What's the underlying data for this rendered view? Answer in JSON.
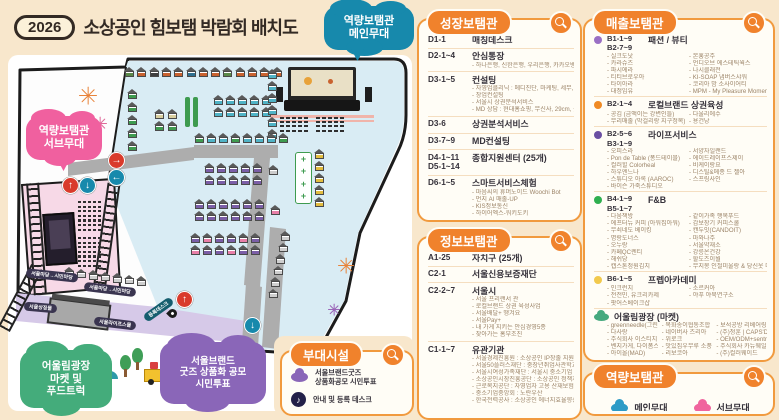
{
  "header": {
    "year_badge": "2026",
    "title": "소상공인 힘보탬 박람회 배치도"
  },
  "colors": {
    "accent_orange": "#F0822C",
    "page_bg": "#F8E7CC",
    "venue_blue": "#D9ECF4",
    "stage_pink": "#F7D9E7",
    "walkway_purple": "#D6C9E8",
    "bubble_blue": "#1789AC",
    "bubble_pink": "#F0609F",
    "bubble_green": "#44AC7B",
    "bubble_purple": "#8A66B8"
  },
  "map": {
    "bubbles": [
      {
        "id": "main-stage-bubble",
        "text": "역량보탬관\n메인무대",
        "color": "#1789AC",
        "x": 324,
        "y": 6,
        "w": 90,
        "h": 44,
        "fs": 11,
        "tail_left": 26
      },
      {
        "id": "sub-stage-bubble",
        "text": "역량보탬관\n서브무대",
        "color": "#F0609F",
        "x": 26,
        "y": 116,
        "w": 76,
        "h": 44,
        "fs": 11,
        "tail_left": 30
      },
      {
        "id": "plaza-bubble",
        "text": "어울림광장\n마켓 및\n푸드트럭",
        "color": "#44AC7B",
        "x": 20,
        "y": 350,
        "w": 92,
        "h": 58,
        "fs": 10.5
      },
      {
        "id": "goods-vote-bubble",
        "text": "서울브랜드\n굿즈 상품화 공모\n시민투표",
        "color": "#8A66B8",
        "x": 160,
        "y": 342,
        "w": 106,
        "h": 62,
        "fs": 9.5
      }
    ],
    "arrows": [
      {
        "sym": "↑",
        "color": "#d93a2b",
        "x": 54,
        "y": 122
      },
      {
        "sym": "↓",
        "color": "#1789ac",
        "x": 71,
        "y": 122
      },
      {
        "sym": "→",
        "color": "#d93a2b",
        "x": 100,
        "y": 97
      },
      {
        "sym": "←",
        "color": "#1789ac",
        "x": 100,
        "y": 114
      },
      {
        "sym": "↑",
        "color": "#d93a2b",
        "x": 168,
        "y": 236
      },
      {
        "sym": "↓",
        "color": "#1789ac",
        "x": 236,
        "y": 262
      }
    ],
    "road_labels": [
      {
        "text": "서울마당→시민마당",
        "x": 18,
        "y": 216,
        "rot": 6,
        "bg": "#3a3550"
      },
      {
        "text": "서울마당→시민마당",
        "x": 76,
        "y": 230,
        "rot": 7,
        "bg": "#3a3550"
      },
      {
        "text": "서울상징물",
        "x": 16,
        "y": 248,
        "rot": 5,
        "bg": "#3a3550"
      },
      {
        "text": "서울라이프스몰",
        "x": 86,
        "y": 264,
        "rot": 7,
        "bg": "#3a3550"
      },
      {
        "text": "등록데스크",
        "x": 134,
        "y": 250,
        "rot": -35,
        "bg": "#155e6e"
      }
    ],
    "fireworks": [
      {
        "x": 80,
        "y": 40,
        "color": "#e8833a",
        "r": 9
      },
      {
        "x": 92,
        "y": 68,
        "color": "#e06a9a",
        "r": 7
      },
      {
        "x": 338,
        "y": 210,
        "color": "#e8833a",
        "r": 8
      },
      {
        "x": 326,
        "y": 254,
        "color": "#9a66b8",
        "r": 6
      }
    ],
    "booth_groups": [
      {
        "x": 116,
        "y": 12,
        "dx": 12.3,
        "dy": 0,
        "colors": [
          "#5a8a4a",
          "#c9622f",
          "#3f3f3f",
          "#c9622f",
          "#c9622f",
          "#2f6f8f",
          "#c9622f",
          "#c9622f",
          "#5a8a4a",
          "#c9622f",
          "#c9622f",
          "#c9622f",
          "#c9622f"
        ]
      },
      {
        "x": 119,
        "y": 34,
        "dx": 0,
        "dy": 13,
        "colors": [
          "#3e9b4f",
          "#3e9b4f",
          "#3e9b4f",
          "#3e9b4f",
          "#3e9b4f"
        ]
      },
      {
        "x": 146,
        "y": 54,
        "dx": 13,
        "dy": 0,
        "colors": [
          "#d9cf9f",
          "#d9cf9f"
        ]
      },
      {
        "x": 146,
        "y": 66,
        "dx": 13,
        "dy": 0,
        "colors": [
          "#3e9b4f",
          "#3e9b4f"
        ]
      },
      {
        "x": 205,
        "y": 40,
        "dx": 12,
        "dy": 0,
        "colors": [
          "#4fb3c6",
          "#4fb3c6",
          "#4fb3c6",
          "#4fb3c6",
          "#4fb3c6"
        ]
      },
      {
        "x": 205,
        "y": 52,
        "dx": 12,
        "dy": 0,
        "colors": [
          "#4fb3c6",
          "#4fb3c6",
          "#4fb3c6",
          "#4fb3c6",
          "#4fb3c6"
        ]
      },
      {
        "x": 259,
        "y": 14,
        "dx": 0,
        "dy": 12,
        "colors": [
          "#4fb3c6",
          "#4fb3c6",
          "#4fb3c6",
          "#4fb3c6",
          "#4fb3c6",
          "#4fb3c6"
        ]
      },
      {
        "x": 186,
        "y": 78,
        "dx": 12,
        "dy": 0,
        "colors": [
          "#3e9b4f",
          "#4fb3c6",
          "#4fb3c6",
          "#3e9b4f",
          "#4fb3c6",
          "#4fb3c6",
          "#4fb3c6",
          "#3e9b4f"
        ]
      },
      {
        "x": 196,
        "y": 108,
        "dx": 12,
        "dy": 0,
        "colors": [
          "#7b5ea7",
          "#7b5ea7",
          "#7b5ea7",
          "#7b5ea7",
          "#7b5ea7"
        ]
      },
      {
        "x": 196,
        "y": 120,
        "dx": 12,
        "dy": 0,
        "colors": [
          "#7b5ea7",
          "#7b5ea7",
          "#7b5ea7",
          "#7b5ea7",
          "#7b5ea7"
        ]
      },
      {
        "x": 260,
        "y": 110,
        "dx": 0,
        "dy": 0,
        "colors": [
          "#cccccc"
        ]
      },
      {
        "x": 186,
        "y": 144,
        "dx": 12,
        "dy": 0,
        "colors": [
          "#7b5ea7",
          "#7b5ea7",
          "#7b5ea7",
          "#7b5ea7",
          "#7b5ea7",
          "#7b5ea7"
        ]
      },
      {
        "x": 186,
        "y": 156,
        "dx": 12,
        "dy": 0,
        "colors": [
          "#7b5ea7",
          "#7b5ea7",
          "#7b5ea7",
          "#7b5ea7",
          "#7b5ea7",
          "#7b5ea7"
        ]
      },
      {
        "x": 262,
        "y": 150,
        "dx": 0,
        "dy": 0,
        "colors": [
          "#e87fa8"
        ]
      },
      {
        "x": 306,
        "y": 94,
        "dx": 0,
        "dy": 12,
        "colors": [
          "#e3bd3f",
          "#e3bd3f",
          "#e3bd3f",
          "#e3bd3f",
          "#e3bd3f"
        ]
      },
      {
        "x": 182,
        "y": 178,
        "dx": 12,
        "dy": 0,
        "colors": [
          "#7b5ea7",
          "#e87fa8",
          "#7b5ea7",
          "#7b5ea7",
          "#e87fa8",
          "#7b5ea7"
        ]
      },
      {
        "x": 182,
        "y": 190,
        "dx": 12,
        "dy": 0,
        "colors": [
          "#e87fa8",
          "#7b5ea7",
          "#7b5ea7",
          "#e87fa8",
          "#7b5ea7",
          "#7b5ea7"
        ]
      },
      {
        "x": 56,
        "y": 212,
        "dx": 12,
        "dy": 1.5,
        "colors": [
          "#cfcfcf",
          "#cfcfcf",
          "#cfcfcf",
          "#cfcfcf",
          "#cfcfcf",
          "#cfcfcf",
          "#cfcfcf"
        ]
      },
      {
        "x": 272,
        "y": 176,
        "dx": -2.5,
        "dy": 11.5,
        "colors": [
          "#cfcfcf",
          "#cfcfcf",
          "#cfcfcf",
          "#cfcfcf",
          "#cfcfcf",
          "#cfcfcf"
        ]
      }
    ],
    "bars": [
      {
        "x": 177,
        "y": 42,
        "w": 5,
        "h": 30
      },
      {
        "x": 185,
        "y": 42,
        "w": 5,
        "h": 30
      }
    ]
  },
  "panels": {
    "growth": {
      "title": "성장보탬관",
      "items": [
        {
          "code": "D1-1",
          "label": "매칭데스크"
        },
        {
          "code": "D2-1~4",
          "label": "안심통장",
          "subs": [
            "하나은행, 신한은행, 우리은행, 카카오뱅크"
          ]
        },
        {
          "code": "D3-1~5",
          "label": "컨설팅",
          "subs": [
            "자영업클리닉 : 메디진단, 마케팅, 세무, 디지털전문",
            "창업컨설팅",
            "서울시 상권분석서비스",
            "MD 상담 : 현대홈쇼핑, 무신사, 29cm, 롯데백화점"
          ]
        },
        {
          "code": "D3-6",
          "label": "상권분석서비스"
        },
        {
          "code": "D3-7~9",
          "label": "MD컨설팅"
        },
        {
          "code": "D4-1~11\nD5-1~14",
          "label": "종합지원센터 (25개)"
        },
        {
          "code": "D6-1~5",
          "label": "스마트서비스체험",
          "subs": [
            "마음씨의 휴머노이드 Woochi Bot",
            "먼지 AI 매출-UP",
            "KIS정보통신",
            "하이어엑스-워키도키",
            "로봇 주식회사-비즈봇"
          ]
        }
      ]
    },
    "info": {
      "title": "정보보탬관",
      "items": [
        {
          "code": "A1-25",
          "label": "자치구 (25개)"
        },
        {
          "code": "C2-1",
          "label": "서울신용보증재단"
        },
        {
          "code": "C2-2~7",
          "label": "서울시",
          "subs": [
            "서울 프리랜서 관",
            "로컬브랜드 상권 육성사업",
            "서울배달+ 땡겨요",
            "서울Pay+",
            "내 가게 지키는 안심경영5종",
            "찾아가는 홈부조진"
          ]
        },
        {
          "code": "C1-1~7",
          "label": "유관기관",
          "subs": [
            "서울경제진흥원 : 소상공인 IP창출 지원사업",
            "서울50플러스재단 : 중장년취업사관학교",
            "서울시여성가족재단 : 서울시 중소기업 워라밸 포인트제",
            "소상공인시장진흥공단 : 소상공인 정책자금",
            "근로복지공단 : 자영업자 고용 산재보험",
            "중소기업중앙회 : 노란우산",
            "한국전력공사 : 소상공인 에너지효율향상 지원사업"
          ]
        }
      ]
    },
    "sales": {
      "title": "매출보탬관",
      "groups": [
        {
          "dot": "#9a6fc4",
          "code": "B1-1~9\nB2-7~9",
          "label": "패션 / 뷰티",
          "cols": [
            [
              "실크도낫",
              "카라슈즈",
              "파시에라",
              "티티브로우아",
              "타이아라",
              "대정임유"
            ],
            [
              "본훙공주",
              "언디오브 에스테틱웍스",
              "나시클래전",
              "KI-SOAP 냅버스샤워",
              "코리아 밤 소사이어티",
              "MPM - My Pleasure Moments"
            ]
          ]
        },
        {
          "dot": "#f08a24",
          "code": "B2-1~4",
          "label": "로컬브랜드 상권육성",
          "cols": [
            [
              "공김 (금액이는 강변인들)",
              "무리매출 (막걸리랑 지구정복)"
            ],
            [
              "다울리에수",
              "용건낭"
            ]
          ]
        },
        {
          "dot": "#6a4fa3",
          "code": "B2-5~6\nB3-1~9",
          "label": "라이프서비스",
          "cols": [
            [
              "오피스라",
              "Pon de Table (퐁드테이블)",
              "컬러힐 Colorheal",
              "하우엔느나",
              "스튜디오 아록 (AAROC)",
              "바이슨 가죽스튜디오"
            ],
            [
              "서양자일랜드",
              "에이드레이프스제이",
              "비케이랑요",
              "디스틸&메종 드 젤아",
              "스프링사인"
            ]
          ]
        },
        {
          "dot": "#2faf4f",
          "code": "B4-1~9\nB5-1~7",
          "label": "F&B",
          "cols": [
            [
              "다움책방",
              "에프터뉴 커피 (아워집아워)",
              "무쇠네도 베이킹",
              "명랑도너스",
              "오누랑",
              "카페QC렌티",
              "해쉬당",
              "캡스톤정원김치"
            ],
            [
              "같이가족 행복푸드",
              "감보장기 커피스쿨",
              "캔두잇(CANDOIT)",
              "마와나주",
              "서울약재소",
              "강릉온건강",
              "할도즈이월",
              "무지몽 인절미울랑 & 당신옷 마을"
            ]
          ]
        },
        {
          "dot": "#f2c94c",
          "code": "B6-1~5",
          "label": "프렙아카데미",
          "cols": [
            [
              "인크런치",
              "전전민, 유크리카제",
              "팟어스베이크샵"
            ],
            [
              "소르커아",
              "야푸 야묵연구소"
            ]
          ]
        },
        {
          "icon": "cloud",
          "code": "",
          "label": "어울림광장 (마켓)",
          "cols": [
            [
              "greenneedle(그린니들)",
              "다사랑",
              "주식회사 이스티치",
              "벤지가게, 다이폼스트",
              "아이올(MAD)",
              "아이올"
            ],
            [
              "목화송이협동조합",
              "네이버사 즈리아",
              "위로크",
              "맛있집우무루 소풍상",
              "리보코아",
              "방짜안공방 진우"
            ],
            [
              "보석공방 리베어링",
              "(주)청훈 | CAPS'DAY",
              "OEM/ODM+sentronics",
              "주식회사 카뉴웨일",
              "(주)컬러웨이드"
            ]
          ]
        },
        {
          "icon": "cloud",
          "code": "",
          "label": "어울림광장 (푸드트럭)",
          "inline": [
            "안녕샐랜도그",
            "요셉",
            "카페 헬로우",
            "주집크리아"
          ]
        }
      ]
    },
    "facility": {
      "title": "부대시설",
      "rows": [
        {
          "icon": "goods-cloud",
          "label": "서울브랜드굿즈\n상품화공모 시민투표"
        },
        {
          "icon": "desk",
          "label": "안내 및 등록 데스크",
          "glyph": "♪"
        }
      ]
    },
    "capability": {
      "title": "역량보탬관",
      "legend": [
        {
          "label": "메인무대",
          "color": "#2E9BC6"
        },
        {
          "label": "서브무대",
          "color": "#F0649E"
        }
      ]
    }
  }
}
